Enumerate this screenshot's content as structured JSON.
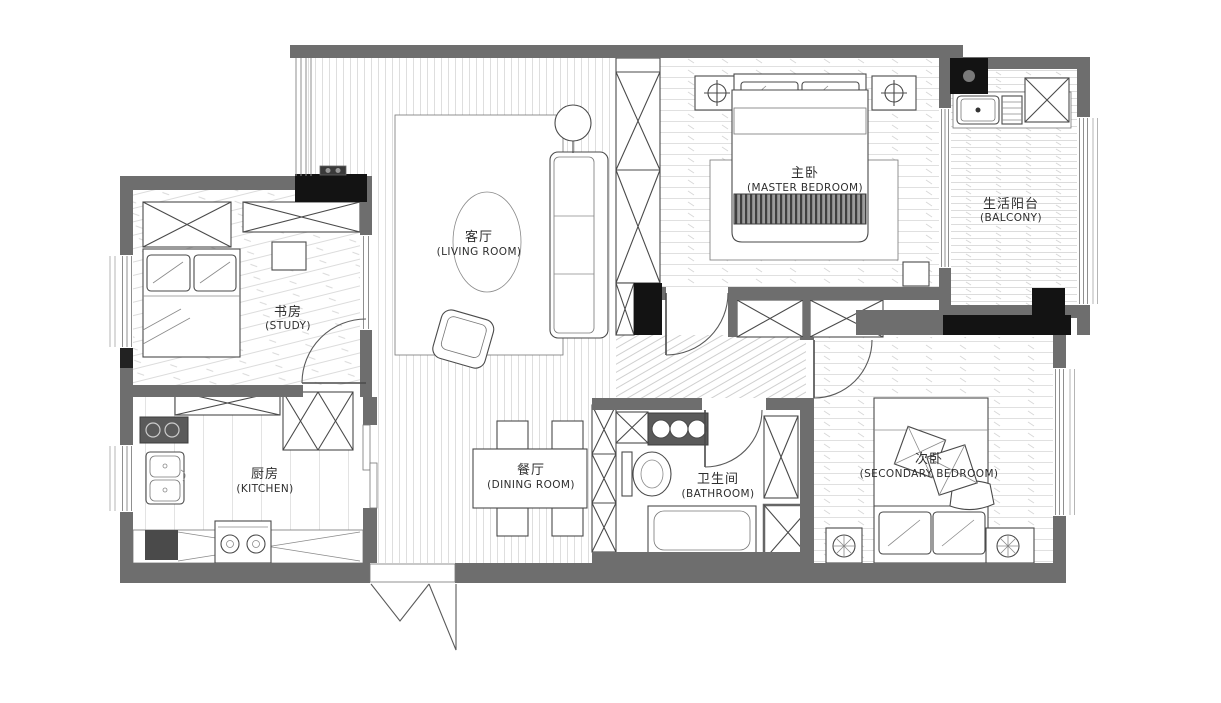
{
  "page": {
    "background": "#ffffff",
    "drawing_type": "apartment floor plan"
  },
  "colors": {
    "wall": "#6e6e6e",
    "structural_column": "#111111",
    "furniture_line": "#4a4a4a",
    "floor_hatch": "#dddddd",
    "counter_dark": "#5a5a5a",
    "bed_runner_band": "#3f3f3f"
  },
  "rooms": [
    {
      "id": "living-room",
      "zh": "客厅",
      "en": "(LIVING ROOM)"
    },
    {
      "id": "master-bedroom",
      "zh": "主卧",
      "en": "(MASTER BEDROOM)"
    },
    {
      "id": "balcony",
      "zh": "生活阳台",
      "en": "(BALCONY)"
    },
    {
      "id": "study",
      "zh": "书房",
      "en": "(STUDY)"
    },
    {
      "id": "kitchen",
      "zh": "厨房",
      "en": "(KITCHEN)"
    },
    {
      "id": "dining-room",
      "zh": "餐厅",
      "en": "(DINING ROOM)"
    },
    {
      "id": "bathroom",
      "zh": "卫生间",
      "en": "(BATHROOM)"
    },
    {
      "id": "secondary-bedroom",
      "zh": "次卧",
      "en": "(SECONDARY BEDROOM)"
    }
  ]
}
